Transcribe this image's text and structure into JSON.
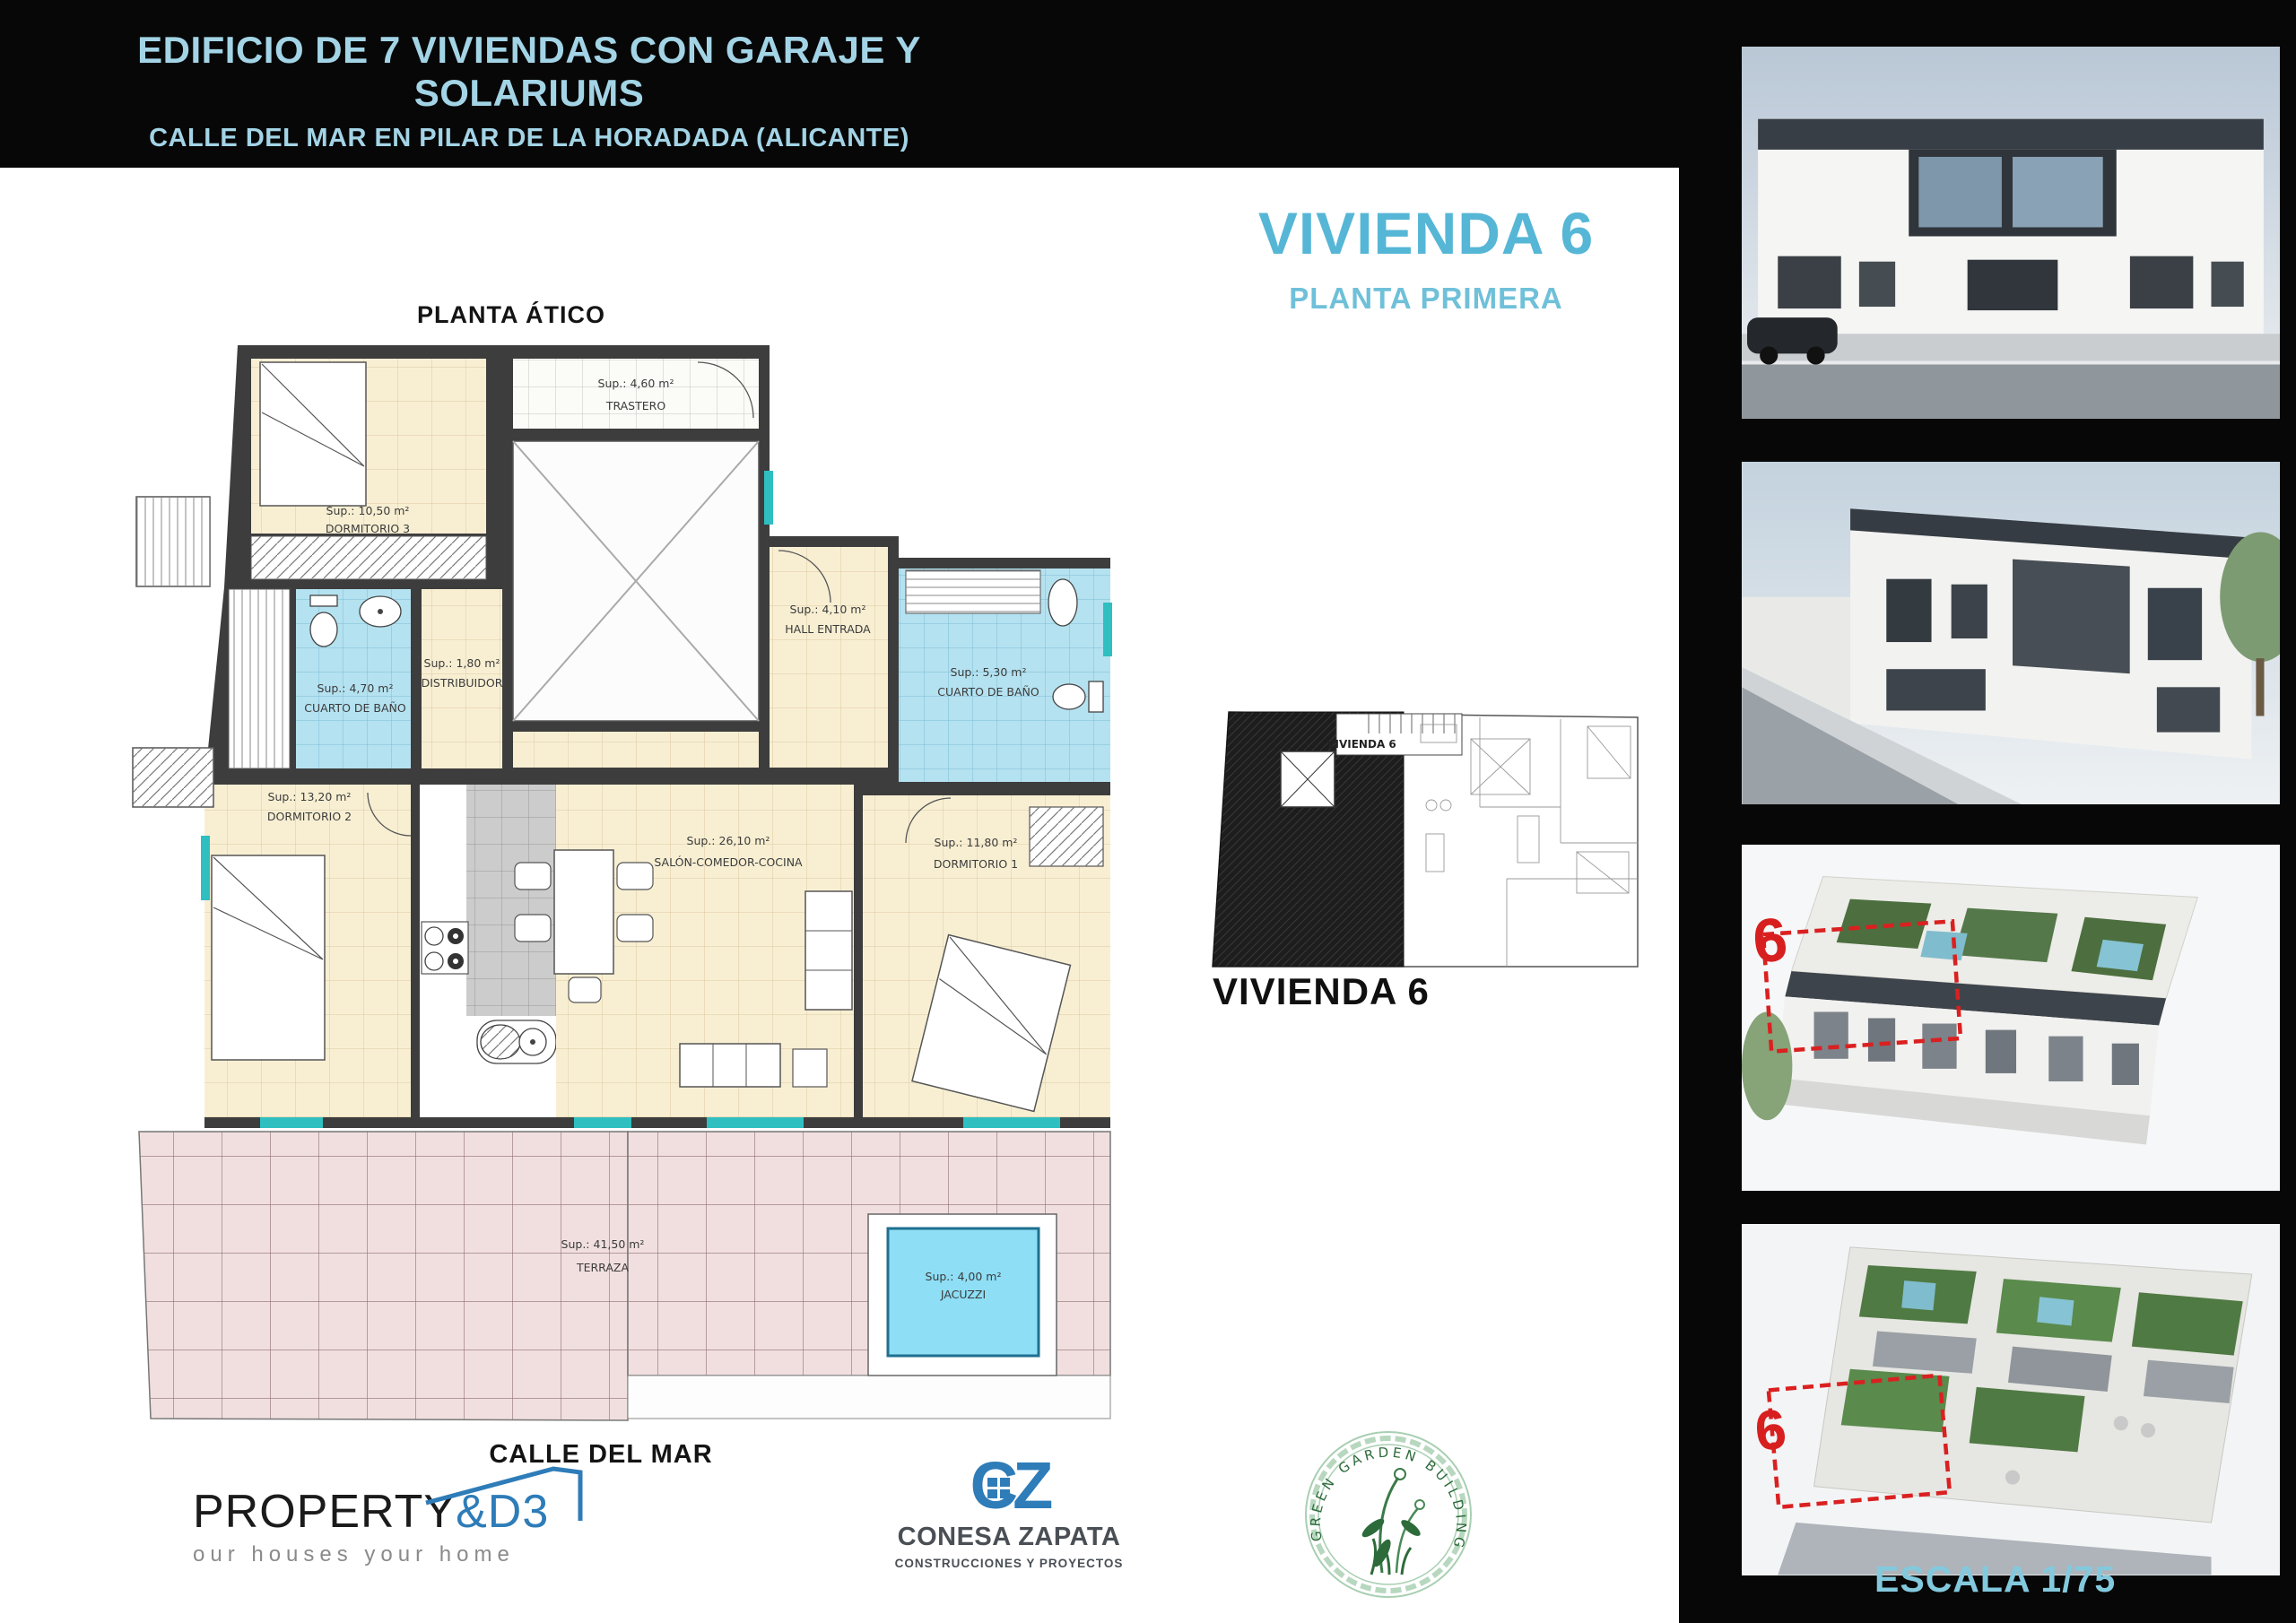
{
  "header": {
    "title": "EDIFICIO DE 7 VIVIENDAS CON GARAJE Y SOLARIUMS",
    "subtitle": "CALLE DEL MAR EN PILAR DE LA HORADADA (ALICANTE)"
  },
  "unit": {
    "title": "VIVIENDA 6",
    "subtitle": "PLANTA PRIMERA"
  },
  "plan": {
    "floor_label": "PLANTA ÁTICO",
    "street_label": "CALLE DEL MAR",
    "rooms": {
      "dormitorio3": {
        "area": "Sup.: 10,50 m²",
        "name": "DORMITORIO 3"
      },
      "trastero": {
        "area": "Sup.: 4,60 m²",
        "name": "TRASTERO"
      },
      "bano_izq": {
        "area": "Sup.: 4,70 m²",
        "name": "CUARTO DE BAÑO"
      },
      "distribuidor": {
        "area": "Sup.: 1,80 m²",
        "name": "DISTRIBUIDOR"
      },
      "hall": {
        "area": "Sup.: 4,10 m²",
        "name": "HALL ENTRADA"
      },
      "bano_der": {
        "area": "Sup.: 5,30 m²",
        "name": "CUARTO DE BAÑO"
      },
      "dormitorio2": {
        "area": "Sup.: 13,20 m²",
        "name": "DORMITORIO 2"
      },
      "salon": {
        "area": "Sup.: 26,10 m²",
        "name": "SALÓN-COMEDOR-COCINA"
      },
      "dormitorio1": {
        "area": "Sup.: 11,80 m²",
        "name": "DORMITORIO 1"
      },
      "terraza": {
        "area": "Sup.: 41,50 m²",
        "name": "TERRAZA"
      },
      "jacuzzi": {
        "area": "Sup.: 4,00 m²",
        "name": "JACUZZI"
      }
    }
  },
  "key_plan": {
    "label": "VIVIENDA 6",
    "mini_label": "VIVIENDA 6"
  },
  "branding": {
    "property": {
      "word": "PROPERTY",
      "suffix": "&D3",
      "tagline": "our houses your home"
    },
    "conesa": {
      "monogram": "CZ",
      "name": "CONESA ZAPATA",
      "tagline": "CONSTRUCCIONES Y PROYECTOS"
    },
    "stamp": {
      "text": "GREEN GARDEN  BUILDING IV"
    }
  },
  "side_panel": {
    "scale_label": "ESCALA 1/75",
    "unit_number": "6"
  },
  "colors": {
    "accent_blue": "#56b6d6",
    "wall": "#3d3d3d",
    "room_cream": "#f8efd3",
    "bath_blue": "#b5e2f0",
    "terrace_pink": "#f1dfdf",
    "jacuzzi_blue": "#8edef5",
    "highlight_red": "#d81f1f",
    "logo_blue": "#2e7cb8",
    "stamp_green": "#2f6b3c"
  }
}
